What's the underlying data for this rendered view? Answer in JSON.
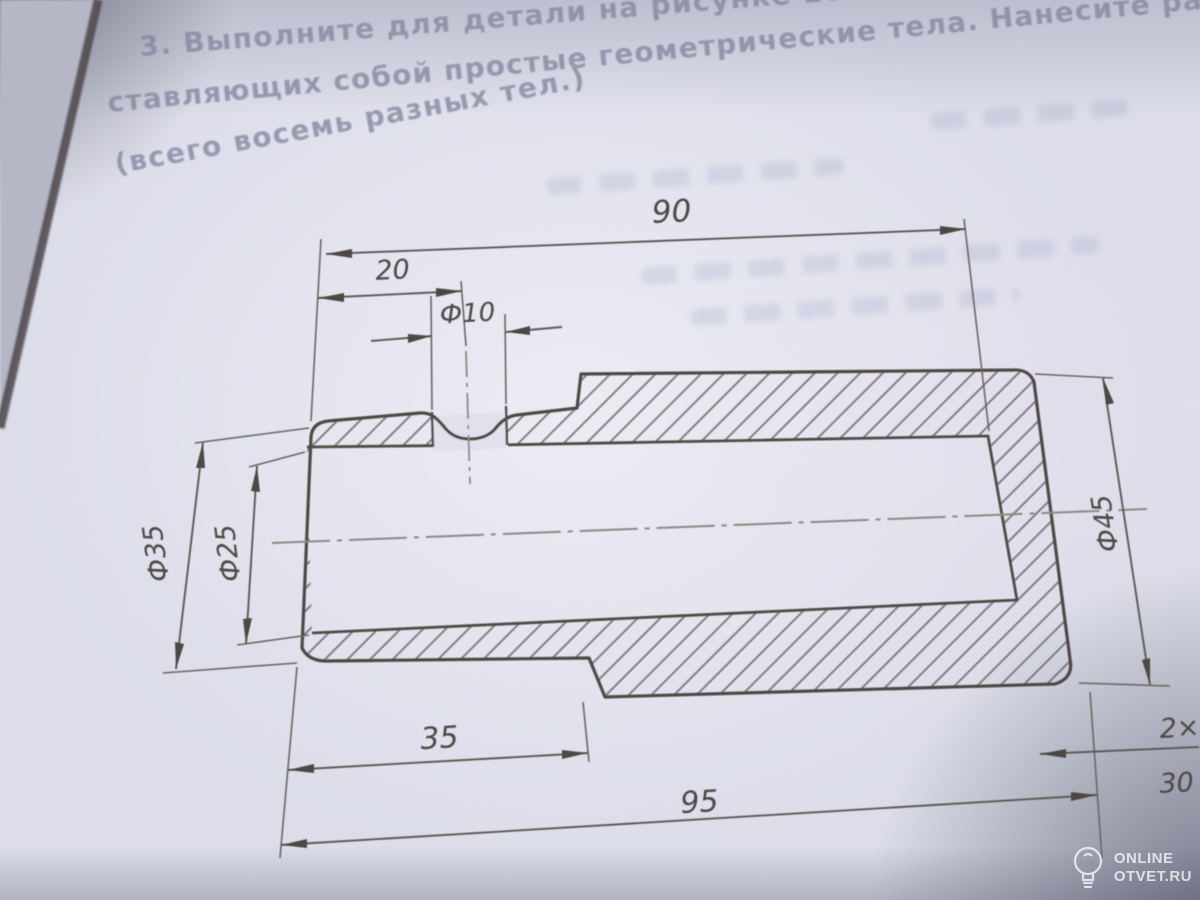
{
  "page_text": {
    "line0": "2. Выполните",
    "line1": "3. Выполните для детали на рисунке 207 чертежи частей, пре",
    "line2": "ставляющих собой простые геометрические тела. Нанесите разме",
    "line3": "(всего восемь разных тел.)"
  },
  "figure": {
    "kind": "sectioned stepped bushing, engineering drawing",
    "dimension_labels": {
      "top_length": "90",
      "hole_offset": "20",
      "hole_diameter": "Ф10",
      "small_outer_diameter": "Ф35",
      "bore_diameter": "Ф25",
      "large_outer_diameter": "Ф45",
      "small_section_length": "35",
      "overall_length": "95",
      "chamfer_note_line1": "2×",
      "chamfer_note_line2": "30"
    }
  },
  "watermark": {
    "icon": "lightbulb-icon",
    "line1": "ONLINE",
    "line2": "OTVET.RU"
  },
  "colors": {
    "paper": "#dcdde9",
    "ink": "#55504a",
    "ghost_text": "#7b86b8",
    "watermark": "#ffffff"
  }
}
